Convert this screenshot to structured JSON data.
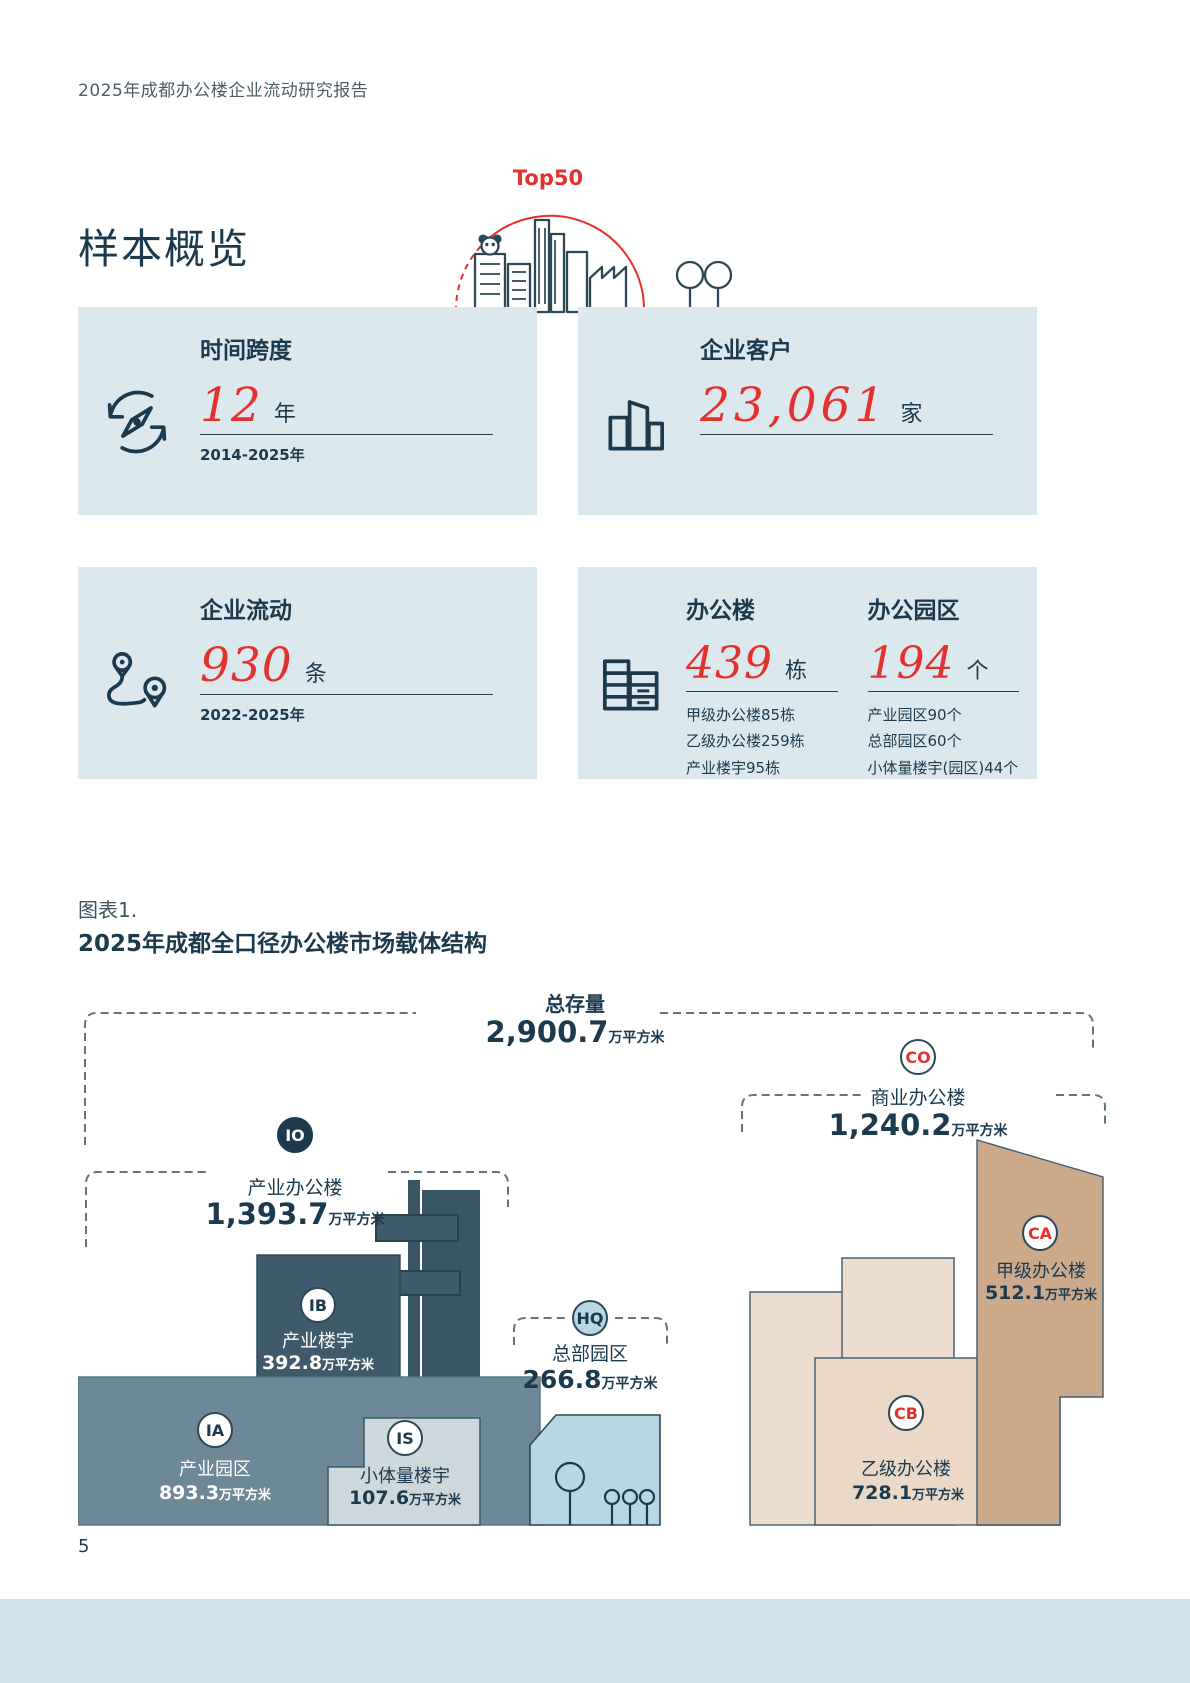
{
  "page": {
    "header": "2025年成都办公楼企业流动研究报告",
    "page_number": "5"
  },
  "overview": {
    "title": "样本概览",
    "badge": "Top50",
    "illustration": "city-skyline-panda-illustration",
    "cards": [
      {
        "id": "time-span",
        "icon": "compass-refresh-icon",
        "title": "时间跨度",
        "value": "12",
        "unit": "年",
        "note": "2014-2025年"
      },
      {
        "id": "clients",
        "icon": "office-buildings-icon",
        "title": "企业客户",
        "value": "23,061",
        "unit": "家"
      },
      {
        "id": "moves",
        "icon": "route-pins-icon",
        "title": "企业流动",
        "value": "930",
        "unit": "条",
        "note": "2022-2025年"
      },
      {
        "id": "stock",
        "icon": "stacked-units-icon",
        "columns": [
          {
            "title": "办公楼",
            "value": "439",
            "unit": "栋",
            "details": [
              "甲级办公楼85栋",
              "乙级办公楼259栋",
              "产业楼宇95栋"
            ]
          },
          {
            "title": "办公园区",
            "value": "194",
            "unit": "个",
            "details": [
              "产业园区90个",
              "总部园区60个",
              "小体量楼宇(园区)44个"
            ]
          }
        ]
      }
    ]
  },
  "figure": {
    "caption": "图表1.",
    "title": "2025年成都全口径办公楼市场载体结构"
  },
  "chart_data": {
    "type": "area",
    "title": "2025年成都全口径办公楼市场载体结构",
    "unit_suffix": "万平方米",
    "layout_hint": "proportional stylized building blocks grouped by dashed brackets; totals on top",
    "total": {
      "label": "总存量",
      "value": 2900.7,
      "display": "2,900.7"
    },
    "groups": [
      {
        "code": "IO",
        "label": "产业办公楼",
        "value": 1393.7,
        "display": "1,393.7"
      },
      {
        "code": "CO",
        "label": "商业办公楼",
        "value": 1240.2,
        "display": "1,240.2"
      },
      {
        "code": "HQ",
        "label": "总部园区",
        "value": 266.8,
        "display": "266.8"
      }
    ],
    "segments": [
      {
        "code": "IA",
        "parent": "IO",
        "label": "产业园区",
        "value": 893.3,
        "display": "893.3",
        "color": "#6d8896"
      },
      {
        "code": "IB",
        "parent": "IO",
        "label": "产业楼宇",
        "value": 392.8,
        "display": "392.8",
        "color": "#3e5a6b"
      },
      {
        "code": "IS",
        "parent": "IO",
        "label": "小体量楼宇",
        "value": 107.6,
        "display": "107.6",
        "color": "#ccd8dc"
      },
      {
        "code": "HQ",
        "parent": "HQ",
        "label": "总部园区",
        "value": 266.8,
        "display": "266.8",
        "color": "#b7d7e3"
      },
      {
        "code": "CA",
        "parent": "CO",
        "label": "甲级办公楼",
        "value": 512.1,
        "display": "512.1",
        "color": "#cbaa8c"
      },
      {
        "code": "CB",
        "parent": "CO",
        "label": "乙级办公楼",
        "value": 728.1,
        "display": "728.1",
        "color": "#ebd8c7"
      }
    ],
    "colors": {
      "accent_red": "#e4312d",
      "navy": "#1c3a4d",
      "card_bg": "#dbe8ee",
      "footer_bar": "#cfe3ea"
    }
  }
}
